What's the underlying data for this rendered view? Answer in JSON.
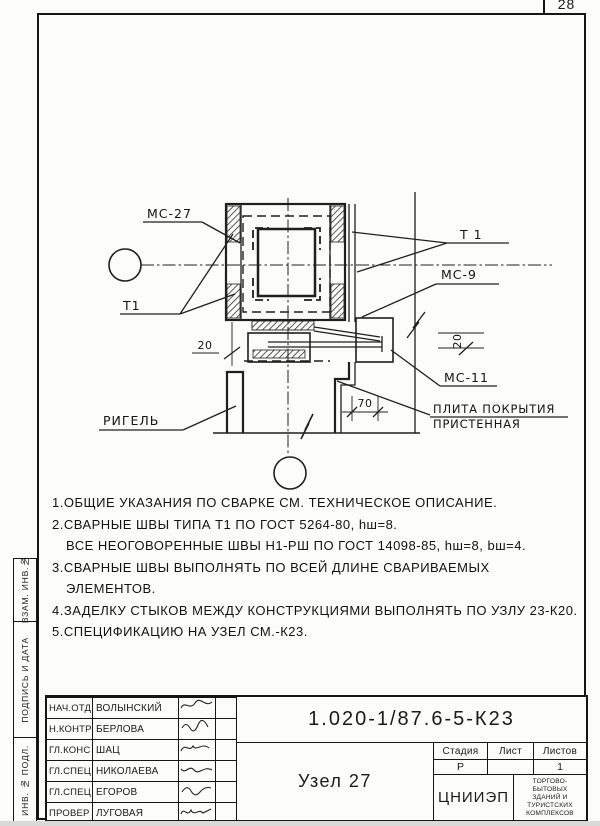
{
  "sheet": {
    "page_number": "28"
  },
  "sidebar": {
    "labels": [
      "ВЗАМ. ИНВ.№",
      "ПОДПИСЬ И ДАТА",
      "ИНВ. № ПОДЛ."
    ]
  },
  "drawing": {
    "callouts": {
      "mc27": "МС-27",
      "t1_left": "Т1",
      "t1_right": "Т 1",
      "mc9": "МС-9",
      "mc11": "МС-11",
      "beam": "РИГЕЛЬ",
      "plate_line1": "ПЛИТА ПОКРЫТИЯ",
      "plate_line2": "ПРИСТЕННАЯ"
    },
    "dimensions": {
      "left": "20",
      "right": "20",
      "bottom": "70"
    }
  },
  "notes": {
    "lines": [
      "1.ОБЩИЕ УКАЗАНИЯ ПО СВАРКЕ СМ. ТЕХНИЧЕСКОЕ ОПИСАНИЕ.",
      "2.СВАРНЫЕ ШВЫ ТИПА Т1 ПО ГОСТ 5264-80, hш=8.",
      "ВСЕ НЕОГОВОРЕННЫЕ ШВЫ Н1-РШ ПО ГОСТ 14098-85, hш=8, bш=4.",
      "3.СВАРНЫЕ ШВЫ ВЫПОЛНЯТЬ ПО ВСЕЙ ДЛИНЕ СВАРИВАЕМЫХ",
      "ЭЛЕМЕНТОВ.",
      "4.ЗАДЕЛКУ СТЫКОВ МЕЖДУ КОНСТРУКЦИЯМИ ВЫПОЛНЯТЬ ПО УЗЛУ 23-К20.",
      "5.СПЕЦИФИКАЦИЮ НА УЗЕЛ СМ.-К23."
    ]
  },
  "title_block": {
    "doc_number": "1.020-1/87.6-5-К23",
    "title": "Узел 27",
    "columns": {
      "stage": "Стадия",
      "sheet": "Лист",
      "sheets": "Листов"
    },
    "values": {
      "stage": "Р",
      "sheet": "",
      "sheets": "1"
    },
    "org": {
      "abbr": "ЦНИИЭП",
      "name_lines": [
        "ТОРГОВО-",
        "БЫТОВЫХ",
        "ЗДАНИЙ И",
        "ТУРИСТСКИХ",
        "КОМПЛЕКСОВ"
      ]
    },
    "people": [
      {
        "role": "НАЧ.ОТД.",
        "name": "ВОЛЫНСКИЙ"
      },
      {
        "role": "Н.КОНТР",
        "name": "БЕРЛОВА"
      },
      {
        "role": "ГЛ.КОНС",
        "name": "ШАЦ"
      },
      {
        "role": "ГЛ.СПЕЦ",
        "name": "НИКОЛАЕВА"
      },
      {
        "role": "ГЛ.СПЕЦ",
        "name": "ЕГОРОВ"
      },
      {
        "role": "ПРОВЕР",
        "name": "ЛУГОВАЯ"
      },
      {
        "role": "РАЗРАБ",
        "name": "ХОРОШИЛОВА"
      }
    ]
  }
}
